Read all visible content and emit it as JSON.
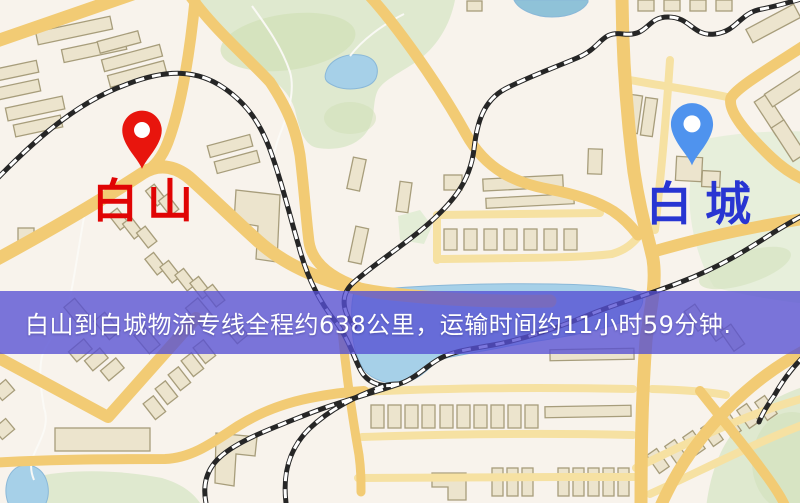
{
  "map": {
    "markers": [
      {
        "id": "origin",
        "label": "白山",
        "pin_color": "#e8150d",
        "label_color": "#e00404"
      },
      {
        "id": "destination",
        "label": "白城",
        "pin_color": "#4f93ee",
        "label_color": "#2835d2"
      }
    ],
    "banner": {
      "text": "白山到白城物流专线全程约638公里，运输时间约11小时59分钟.",
      "background": "#5650d4",
      "opacity": 0.78,
      "text_color": "#ffffff"
    },
    "route": {
      "from": "白山",
      "to": "白城",
      "distance_text": "约638公里",
      "duration_text": "约11小时59分钟"
    },
    "colors": {
      "background": "#f8f3ec",
      "park": "#dfe9cf",
      "park_pale": "#e7efdb",
      "park_dark": "#cfe0b8",
      "water": "#a6d0e8",
      "road_major": "#f2cb74",
      "road_minor": "#f6e1a2",
      "building_fill": "#ece4cd",
      "building_stroke": "#a79d7b",
      "railway_dark": "#262626",
      "railway_light": "#ffffff",
      "stream": "#fbfaf7"
    }
  }
}
